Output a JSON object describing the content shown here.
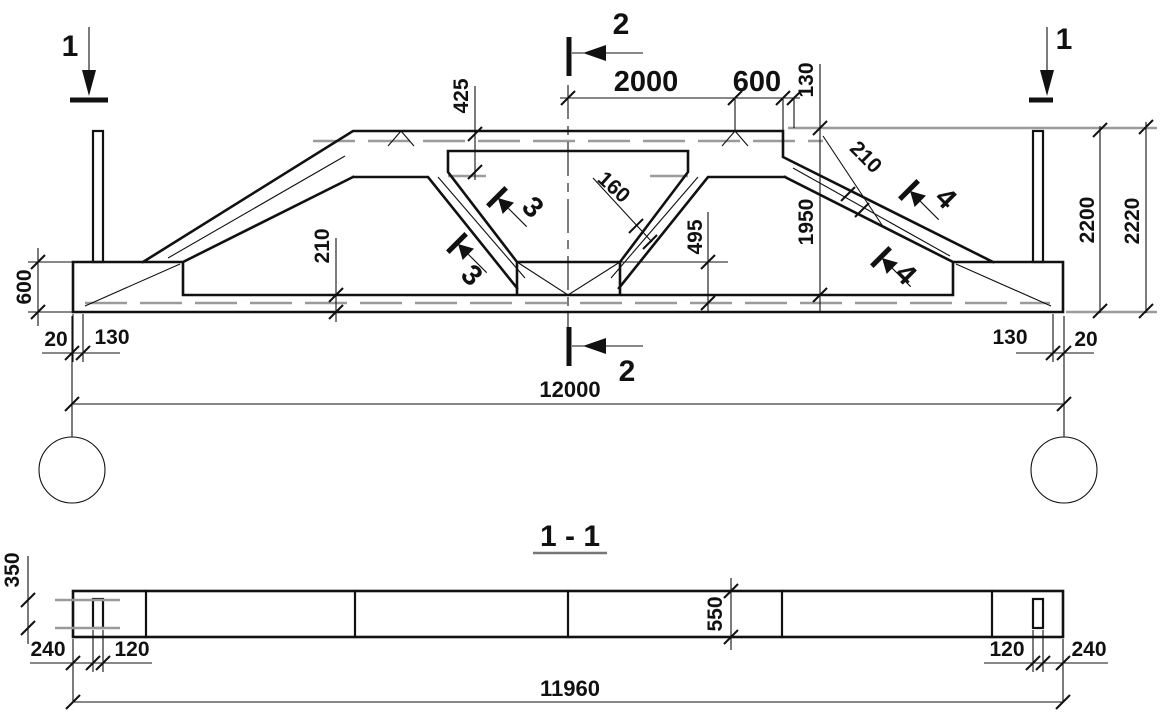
{
  "colors": {
    "ink": "#111111",
    "grey": "#9b9b9b",
    "background": "#ffffff"
  },
  "elevation": {
    "markers": {
      "one": "1",
      "two": "2",
      "three": "3",
      "four": "4"
    },
    "dims": {
      "d2000": "2000",
      "d600_top": "600",
      "d130_top": "130",
      "d425": "425",
      "d160": "160",
      "d495": "495",
      "d210_right": "210",
      "d1950": "1950",
      "d2200": "2200",
      "d2220": "2220",
      "d600_left": "600",
      "d210_left": "210",
      "d20_left": "20",
      "d130_left": "130",
      "d130_right": "130",
      "d20_right": "20",
      "d12000": "12000"
    }
  },
  "section": {
    "title": "1 - 1",
    "dims": {
      "d350": "350",
      "d240_left": "240",
      "d120_left": "120",
      "d550": "550",
      "d120_right": "120",
      "d240_right": "240",
      "d11960": "11960"
    }
  }
}
